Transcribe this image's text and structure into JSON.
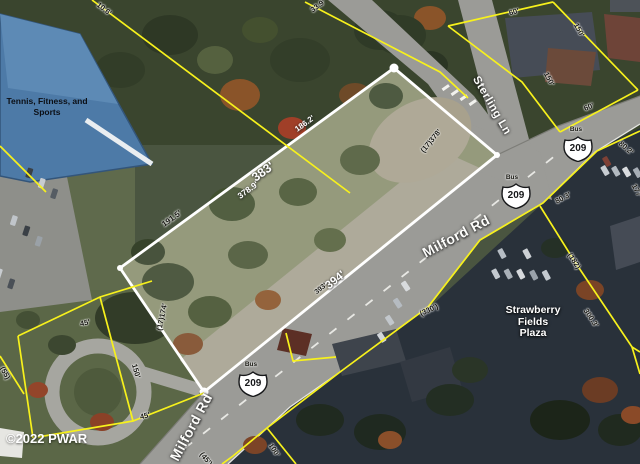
{
  "map": {
    "copyright": "©2022 PWAR",
    "roads": {
      "milford_label_1": "Milford Rd",
      "milford_label_2": "Milford Rd",
      "sterling_label": "Sterling Ln"
    },
    "route_shields": [
      {
        "route": "209",
        "banner": "Bus"
      },
      {
        "route": "209",
        "banner": "Bus"
      },
      {
        "route": "209",
        "banner": "Bus"
      }
    ],
    "places": {
      "tennis_line1": "Tennis, Fitness, and",
      "tennis_line2": "Sports",
      "plaza_line1": "Strawberry",
      "plaza_line2": "Fields",
      "plaza_line3": "Plaza"
    },
    "highlight_parcel_dimensions": [
      {
        "text": "186.2'"
      },
      {
        "text": "383'"
      },
      {
        "text": "378.9'"
      },
      {
        "text": "191.5'"
      },
      {
        "text": "(17)378'"
      },
      {
        "text": "(17)174'"
      },
      {
        "text": "393'"
      },
      {
        "text": "394'"
      }
    ],
    "lot_dimensions": [
      {
        "text": "10.6'"
      },
      {
        "text": "33.9'"
      },
      {
        "text": "60'"
      },
      {
        "text": "150'"
      },
      {
        "text": "150'"
      },
      {
        "text": "60'"
      },
      {
        "text": "80.2'"
      },
      {
        "text": "177'"
      },
      {
        "text": "80.3'"
      },
      {
        "text": "(182)"
      },
      {
        "text": "300.3'"
      },
      {
        "text": "(330')"
      },
      {
        "text": "100'"
      },
      {
        "text": "(45')"
      },
      {
        "text": "45'"
      },
      {
        "text": "150'"
      },
      {
        "text": "45'"
      },
      {
        "text": "(55)"
      }
    ]
  }
}
